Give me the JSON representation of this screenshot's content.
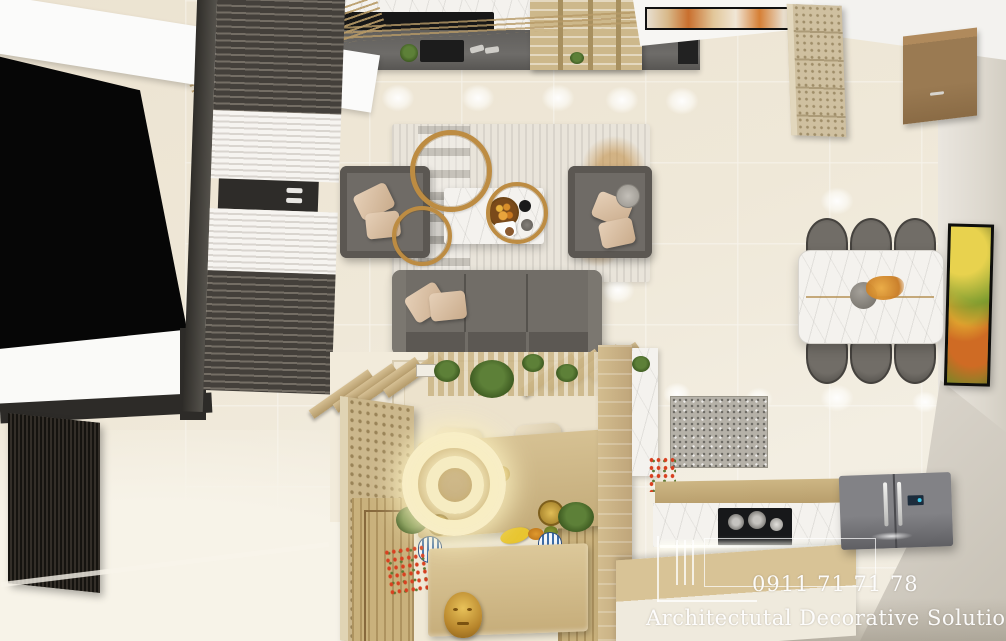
{
  "scene": {
    "type": "top-down 3D interior render",
    "areas": [
      "window-bay",
      "living-room",
      "dining-area",
      "tea-corner",
      "kitchen"
    ]
  },
  "watermark": {
    "phone": "0911 71 71 78",
    "brand": "Architectutal Decorative Solutions",
    "text_color": "#FFFFFF"
  },
  "palette": {
    "floor_tile": "#EFE8D8",
    "wood_tan": "#C9B385",
    "sofa_gray": "#6F6B66",
    "marble_white": "#F4F2EE",
    "gold_accent": "#BD8C42",
    "curtain_dark": "#44403B",
    "sheer_white": "#F2EFEA",
    "right_wall": "#E6E1DA",
    "zen_rug": "#CDB783",
    "ring_glow": "#F8EEC6",
    "red_flowers": "#D84020",
    "plant_green": "#4F7A30",
    "fridge_gray": "#6E6E71",
    "artwork_accent": "#CF6B24",
    "window_void": "#060606"
  }
}
